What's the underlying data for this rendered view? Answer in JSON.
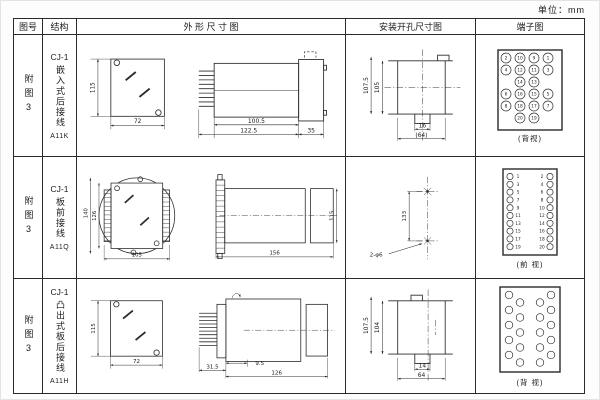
{
  "unit_label": "单位：mm",
  "header": {
    "fig_no": "图号",
    "structure": "结构",
    "outline": "外 形 尺 寸 图",
    "mounting": "安装开孔尺寸图",
    "terminal": "端子图"
  },
  "rows": [
    {
      "fig_no": "附图3",
      "model": "CJ-1",
      "mount_type": "嵌入式后接线",
      "code": "A11K",
      "outline": {
        "height": "115",
        "width": "72",
        "case_length": "100.5",
        "total_length": "122.5",
        "rear_depth": "35"
      },
      "mounting": {
        "outer_height": "107.5",
        "inner_height": "105",
        "notch_width": "16",
        "cutout_width": "(64)"
      },
      "terminal": {
        "view": "(背视)",
        "r": 5,
        "points": [
          {
            "x": 21,
            "y": 10,
            "n": "2"
          },
          {
            "x": 35,
            "y": 10,
            "n": "10"
          },
          {
            "x": 49,
            "y": 10,
            "n": "9"
          },
          {
            "x": 63,
            "y": 10,
            "n": "1"
          },
          {
            "x": 21,
            "y": 22,
            "n": "4"
          },
          {
            "x": 35,
            "y": 22,
            "n": "12"
          },
          {
            "x": 49,
            "y": 22,
            "n": "11"
          },
          {
            "x": 63,
            "y": 22,
            "n": "3"
          },
          {
            "x": 35,
            "y": 34,
            "n": "14"
          },
          {
            "x": 49,
            "y": 34,
            "n": "13"
          },
          {
            "x": 21,
            "y": 46,
            "n": "6"
          },
          {
            "x": 35,
            "y": 46,
            "n": "16"
          },
          {
            "x": 49,
            "y": 46,
            "n": "15"
          },
          {
            "x": 63,
            "y": 46,
            "n": "5"
          },
          {
            "x": 21,
            "y": 58,
            "n": "8"
          },
          {
            "x": 35,
            "y": 58,
            "n": "18"
          },
          {
            "x": 49,
            "y": 58,
            "n": "17"
          },
          {
            "x": 63,
            "y": 58,
            "n": "7"
          },
          {
            "x": 35,
            "y": 70,
            "n": "20"
          },
          {
            "x": 49,
            "y": 70,
            "n": "19"
          }
        ]
      }
    },
    {
      "fig_no": "附图3",
      "model": "CJ-1",
      "mount_type": "板前接线",
      "code": "A11Q",
      "outline": {
        "flange_height": "140",
        "inner_height": "126",
        "width": "105",
        "length": "156",
        "body_height": "115"
      },
      "mounting": {
        "hole_spacing": "133",
        "hole_spec": "2-φ6"
      },
      "terminal": {
        "view": "(前 视)",
        "r": 3.1,
        "points": [
          {
            "x": 25,
            "y": 10.5,
            "n": "1",
            "tx": 33
          },
          {
            "x": 65,
            "y": 10.5,
            "n": "2",
            "tx": 57
          },
          {
            "x": 25,
            "y": 18.3,
            "n": "3",
            "tx": 33
          },
          {
            "x": 65,
            "y": 18.3,
            "n": "4",
            "tx": 57
          },
          {
            "x": 25,
            "y": 26.1,
            "n": "5",
            "tx": 33
          },
          {
            "x": 65,
            "y": 26.1,
            "n": "6",
            "tx": 57
          },
          {
            "x": 25,
            "y": 33.9,
            "n": "7",
            "tx": 33
          },
          {
            "x": 65,
            "y": 33.9,
            "n": "8",
            "tx": 57
          },
          {
            "x": 25,
            "y": 41.7,
            "n": "9",
            "tx": 33
          },
          {
            "x": 65,
            "y": 41.7,
            "n": "10",
            "tx": 57
          },
          {
            "x": 25,
            "y": 49.5,
            "n": "11",
            "tx": 33
          },
          {
            "x": 65,
            "y": 49.5,
            "n": "12",
            "tx": 57
          },
          {
            "x": 25,
            "y": 57.3,
            "n": "13",
            "tx": 33
          },
          {
            "x": 65,
            "y": 57.3,
            "n": "14",
            "tx": 57
          },
          {
            "x": 25,
            "y": 65.1,
            "n": "15",
            "tx": 33
          },
          {
            "x": 65,
            "y": 65.1,
            "n": "16",
            "tx": 57
          },
          {
            "x": 25,
            "y": 72.9,
            "n": "17",
            "tx": 33
          },
          {
            "x": 65,
            "y": 72.9,
            "n": "18",
            "tx": 57
          },
          {
            "x": 25,
            "y": 80.7,
            "n": "19",
            "tx": 33
          },
          {
            "x": 65,
            "y": 80.7,
            "n": "20",
            "tx": 57
          }
        ]
      }
    },
    {
      "fig_no": "附图3",
      "model": "CJ-1",
      "mount_type": "凸出式板后接线",
      "code": "A11H",
      "outline": {
        "height": "115",
        "width": "72",
        "pin_length": "31.5",
        "offset": "9.5",
        "body_length": "126"
      },
      "mounting": {
        "outer_height": "107.5",
        "inner_height": "104",
        "notch_width": "14",
        "cutout_width": "64"
      },
      "terminal": {
        "view": "(背 视)",
        "r": 3.8,
        "points": [
          {
            "x": 24,
            "y": 10
          },
          {
            "x": 24,
            "y": 25
          },
          {
            "x": 24,
            "y": 40
          },
          {
            "x": 24,
            "y": 55
          },
          {
            "x": 24,
            "y": 70
          },
          {
            "x": 35,
            "y": 17.5
          },
          {
            "x": 35,
            "y": 32.5
          },
          {
            "x": 35,
            "y": 47.5
          },
          {
            "x": 35,
            "y": 62.5
          },
          {
            "x": 35,
            "y": 77.5
          },
          {
            "x": 55,
            "y": 17.5
          },
          {
            "x": 55,
            "y": 32.5
          },
          {
            "x": 55,
            "y": 47.5
          },
          {
            "x": 55,
            "y": 62.5
          },
          {
            "x": 55,
            "y": 77.5
          },
          {
            "x": 66,
            "y": 10
          },
          {
            "x": 66,
            "y": 25
          },
          {
            "x": 66,
            "y": 40
          },
          {
            "x": 66,
            "y": 55
          },
          {
            "x": 66,
            "y": 70
          }
        ]
      }
    }
  ]
}
